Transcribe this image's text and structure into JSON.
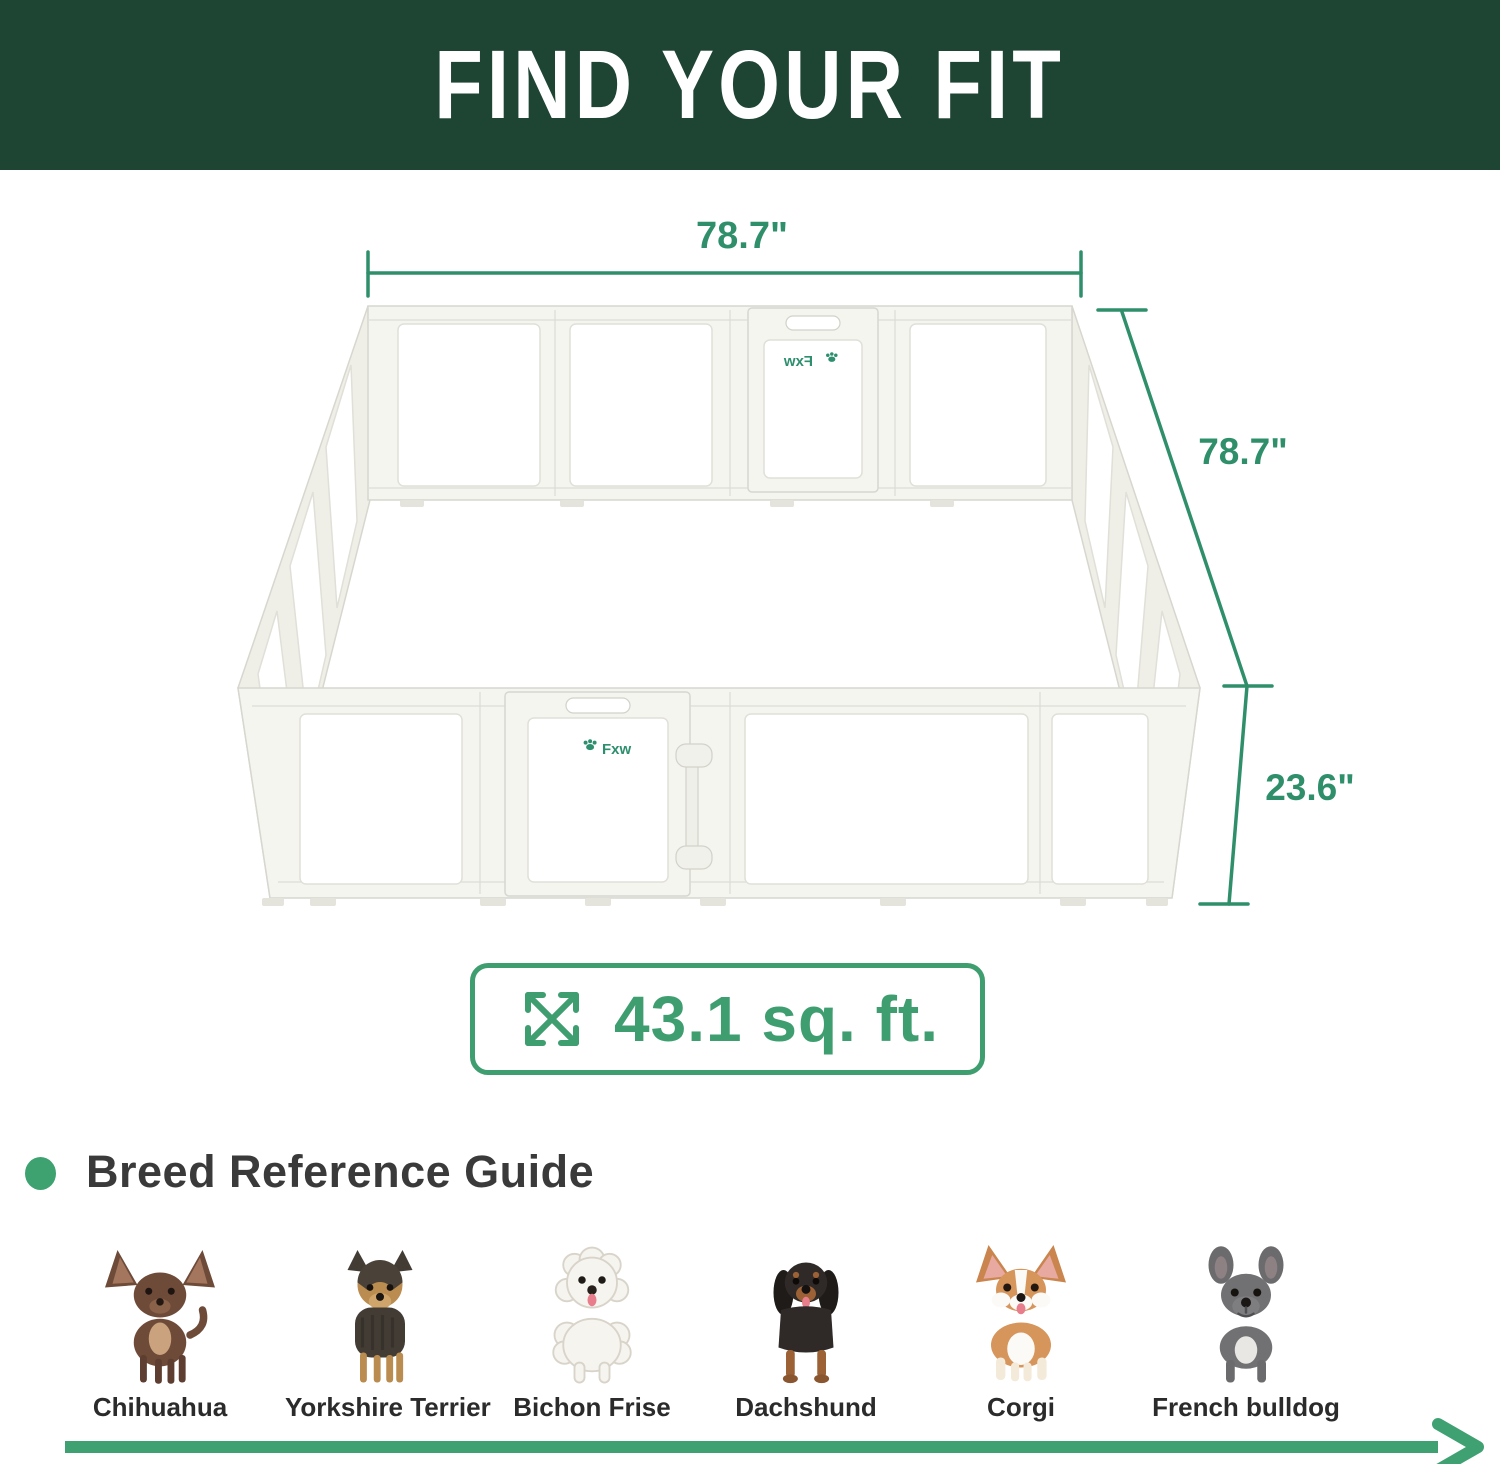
{
  "header": {
    "title": "FIND YOUR FIT"
  },
  "dimensions": {
    "width_label": "78.7\"",
    "depth_label": "78.7\"",
    "height_label": "23.6\"",
    "area_label": "43.1 sq. ft."
  },
  "brand": {
    "front_door_logo": "Fxw",
    "back_door_logo": "Fxw"
  },
  "breed_guide": {
    "heading": "Breed Reference Guide",
    "breeds": [
      {
        "name": "Chihuahua"
      },
      {
        "name": "Yorkshire Terrier"
      },
      {
        "name": "Bichon Frise"
      },
      {
        "name": "Dachshund"
      },
      {
        "name": "Corgi"
      },
      {
        "name": "French bulldog"
      }
    ]
  },
  "colors": {
    "header_bg": "#1e4434",
    "dimension_green": "#2f8f6b",
    "accent_green": "#3f9e70",
    "arrow_green": "#3fa172",
    "dot_green": "#3da26f",
    "pen_frame": "#f5f5f0"
  }
}
